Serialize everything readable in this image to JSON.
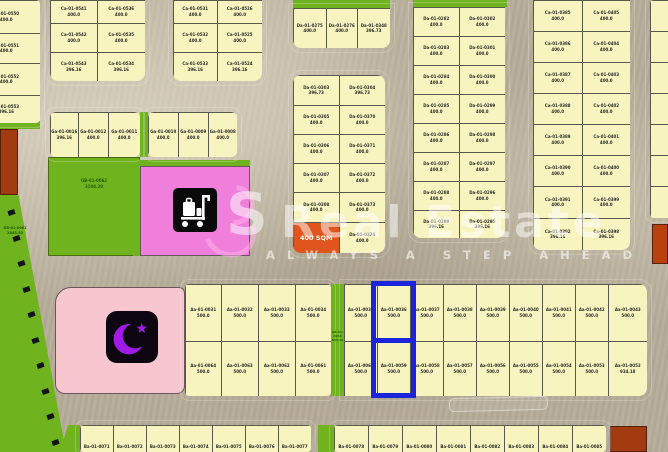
{
  "watermark": {
    "logo_letter": "S",
    "brand": "Real Estate",
    "tagline": "ALWAYS A STEP AHEAD"
  },
  "selection": {
    "plot_ids": [
      "Aa-01-0036",
      "Aa-01-0059"
    ],
    "highlight_color": "#1b23dd"
  },
  "green_areas": {
    "main": {
      "id": "GB-01-0062",
      "area": "3104.20"
    },
    "left": {
      "id": "GB-01-0061",
      "area": "2845.50"
    },
    "mid_strip": {
      "id": "GB-01-0063",
      "area": "583.30"
    }
  },
  "icons": {
    "mosque": "crescent-and-star",
    "services": "luggage-cart"
  },
  "colors": {
    "road": "#b6ac99",
    "plot": "#f7f4c0",
    "green": "#6fb41f",
    "pink_services": "#f07fdb",
    "pink_mosque": "#f8c6ce",
    "dark_red": "#a33b10",
    "orange_highlight": "#e0551d",
    "selection_blue": "#1b23dd",
    "crescent_purple": "#a21ae8"
  },
  "blocks": {
    "left_col": {
      "plots": [
        {
          "id": "Ca-01-0550",
          "area": "400.0"
        },
        {
          "id": "Ca-01-0551",
          "area": "400.0"
        },
        {
          "id": "Ca-01-0552",
          "area": "400.0"
        },
        {
          "id": "Ca-01-0553",
          "area": "396.16"
        }
      ]
    },
    "top_left": {
      "plots": [
        {
          "id": "Ca-01-0541",
          "area": "400.0"
        },
        {
          "id": "Ca-01-0536",
          "area": "400.0"
        },
        {
          "id": "Ca-01-0542",
          "area": "400.0"
        },
        {
          "id": "Ca-01-0535",
          "area": "400.0"
        },
        {
          "id": "Ca-01-0543",
          "area": "396.16"
        },
        {
          "id": "Ca-01-0534",
          "area": "396.16"
        }
      ]
    },
    "top_center_left": {
      "plots": [
        {
          "id": "Ca-01-0531",
          "area": "400.0"
        },
        {
          "id": "Ca-01-0526",
          "area": "400.0"
        },
        {
          "id": "Ca-01-0532",
          "area": "400.0"
        },
        {
          "id": "Ca-01-0525",
          "area": "400.0"
        },
        {
          "id": "Ca-01-0533",
          "area": "396.16"
        },
        {
          "id": "Ca-01-0524",
          "area": "396.16"
        }
      ]
    },
    "top_center_strip": {
      "plots": [
        {
          "id": "Da-01-0275",
          "area": "400.0"
        },
        {
          "id": "Da-01-0276",
          "area": "400.0"
        },
        {
          "id": "Da-01-0348",
          "area": "396.73"
        }
      ]
    },
    "center": {
      "plots": [
        {
          "id": "Da-01-0303",
          "area": "396.73"
        },
        {
          "id": "Da-01-0304",
          "area": "396.73"
        },
        {
          "id": "Da-01-0305",
          "area": "400.0"
        },
        {
          "id": "Da-01-0370",
          "area": "400.0"
        },
        {
          "id": "Da-01-0306",
          "area": "400.0"
        },
        {
          "id": "Da-01-0371",
          "area": "400.0"
        },
        {
          "id": "Da-01-0307",
          "area": "400.0"
        },
        {
          "id": "Da-01-0372",
          "area": "400.0"
        },
        {
          "id": "Da-01-0308",
          "area": "400.0"
        },
        {
          "id": "Da-01-0373",
          "area": "400.0"
        },
        {
          "label": "400 SQM",
          "highlight": "orange"
        },
        {
          "id": "Da-01-0374",
          "area": "400.0"
        }
      ]
    },
    "right_center": {
      "plots": [
        {
          "id": "Da-01-0282",
          "area": "400.0"
        },
        {
          "id": "Da-01-0302",
          "area": "400.0"
        },
        {
          "id": "Da-01-0283",
          "area": "400.0"
        },
        {
          "id": "Da-01-0301",
          "area": "400.0"
        },
        {
          "id": "Da-01-0284",
          "area": "400.0"
        },
        {
          "id": "Da-01-0300",
          "area": "400.0"
        },
        {
          "id": "Da-01-0285",
          "area": "400.0"
        },
        {
          "id": "Da-01-0299",
          "area": "400.0"
        },
        {
          "id": "Da-01-0286",
          "area": "400.0"
        },
        {
          "id": "Da-01-0298",
          "area": "400.0"
        },
        {
          "id": "Da-01-0287",
          "area": "400.0"
        },
        {
          "id": "Da-01-0297",
          "area": "400.0"
        },
        {
          "id": "Da-01-0288",
          "area": "400.0"
        },
        {
          "id": "Da-01-0296",
          "area": "400.0"
        },
        {
          "id": "Da-01-0289",
          "area": "396.16"
        },
        {
          "id": "Da-01-0295",
          "area": "396.16"
        }
      ]
    },
    "right_block": {
      "plots": [
        {
          "id": "Ca-01-0385",
          "area": "400.0"
        },
        {
          "id": "Ca-01-0405",
          "area": "400.0"
        },
        {
          "id": "Ca-01-0386",
          "area": "400.0"
        },
        {
          "id": "Ca-01-0404",
          "area": "400.0"
        },
        {
          "id": "Ca-01-0387",
          "area": "400.0"
        },
        {
          "id": "Ca-01-0403",
          "area": "400.0"
        },
        {
          "id": "Ca-01-0388",
          "area": "400.0"
        },
        {
          "id": "Ca-01-0402",
          "area": "400.0"
        },
        {
          "id": "Ca-01-0389",
          "area": "400.0"
        },
        {
          "id": "Ca-01-0401",
          "area": "400.0"
        },
        {
          "id": "Ca-01-0390",
          "area": "400.0"
        },
        {
          "id": "Ca-01-0400",
          "area": "400.0"
        },
        {
          "id": "Ca-01-0391",
          "area": "400.0"
        },
        {
          "id": "Ca-01-0399",
          "area": "400.0"
        },
        {
          "id": "Ca-01-0392",
          "area": "396.16"
        },
        {
          "id": "Ca-01-0398",
          "area": "396.16"
        }
      ]
    },
    "right_edge_col": {
      "plots": [
        {
          "id": "Ca-01-0412",
          "area": "400.0"
        },
        {
          "id": "Ca-01-0413",
          "area": "400.0"
        },
        {
          "id": "Ca-01-0414",
          "area": "400.0"
        },
        {
          "id": "Ca-01-0415",
          "area": "400.0"
        },
        {
          "id": "Ca-01-0416",
          "area": "400.0"
        },
        {
          "id": "Ca-01-0417",
          "area": "400.0"
        },
        {
          "id": "Ca-01-0418",
          "area": "400.0"
        }
      ]
    },
    "row_g1": {
      "plots": [
        {
          "id": "Ga-01-0016",
          "area": "396.16"
        },
        {
          "id": "Ga-01-0012",
          "area": "400.0"
        },
        {
          "id": "Ga-01-0011",
          "area": "400.0"
        }
      ]
    },
    "row_g2": {
      "plots": [
        {
          "id": "Ga-01-0010",
          "area": "400.0"
        },
        {
          "id": "Ga-01-0009",
          "area": "400.0"
        },
        {
          "id": "Ga-01-0008",
          "area": "400.0"
        }
      ]
    },
    "mid_left": {
      "plots": [
        {
          "id": "Aa-01-0031",
          "area": "500.0"
        },
        {
          "id": "Aa-01-0032",
          "area": "500.0"
        },
        {
          "id": "Aa-01-0033",
          "area": "500.0"
        },
        {
          "id": "Aa-01-0034",
          "area": "500.0"
        },
        {
          "id": "Aa-01-0064",
          "area": "500.0"
        },
        {
          "id": "Aa-01-0063",
          "area": "500.0"
        },
        {
          "id": "Aa-01-0062",
          "area": "500.0"
        },
        {
          "id": "Aa-01-0061",
          "area": "500.0"
        }
      ]
    },
    "mid_right": {
      "plots": [
        {
          "id": "Aa-01-0035",
          "area": "500.0"
        },
        {
          "id": "Aa-01-0036",
          "area": "500.0"
        },
        {
          "id": "Aa-01-0037",
          "area": "500.0"
        },
        {
          "id": "Aa-01-0038",
          "area": "500.0"
        },
        {
          "id": "Aa-01-0039",
          "area": "500.0"
        },
        {
          "id": "Aa-01-0040",
          "area": "500.0"
        },
        {
          "id": "Aa-01-0041",
          "area": "500.0"
        },
        {
          "id": "Aa-01-0042",
          "area": "500.0"
        },
        {
          "id": "Aa-01-0043",
          "area": "500.0"
        },
        {
          "id": "Aa-01-0060",
          "area": "500.0"
        },
        {
          "id": "Aa-01-0059",
          "area": "500.0"
        },
        {
          "id": "Aa-01-0058",
          "area": "500.0"
        },
        {
          "id": "Aa-01-0057",
          "area": "500.0"
        },
        {
          "id": "Aa-01-0056",
          "area": "500.0"
        },
        {
          "id": "Aa-01-0055",
          "area": "500.0"
        },
        {
          "id": "Aa-01-0054",
          "area": "500.0"
        },
        {
          "id": "Aa-01-0053",
          "area": "500.0"
        },
        {
          "id": "Aa-01-0052",
          "area": "934.18"
        }
      ]
    },
    "bottom_left": {
      "plots": [
        {
          "id": "Ba-01-0071"
        },
        {
          "id": "Ba-01-0072"
        },
        {
          "id": "Ba-01-0073"
        },
        {
          "id": "Ba-01-0074"
        },
        {
          "id": "Ba-01-0075"
        },
        {
          "id": "Ba-01-0076"
        },
        {
          "id": "Ba-01-0077"
        }
      ]
    },
    "bottom_right": {
      "plots": [
        {
          "id": "Ba-01-0078"
        },
        {
          "id": "Ba-01-0079"
        },
        {
          "id": "Ba-01-0080"
        },
        {
          "id": "Ba-01-0081"
        },
        {
          "id": "Ba-01-0082"
        },
        {
          "id": "Ba-01-0083"
        },
        {
          "id": "Ba-01-0084"
        },
        {
          "id": "Ba-01-0085"
        }
      ]
    }
  }
}
